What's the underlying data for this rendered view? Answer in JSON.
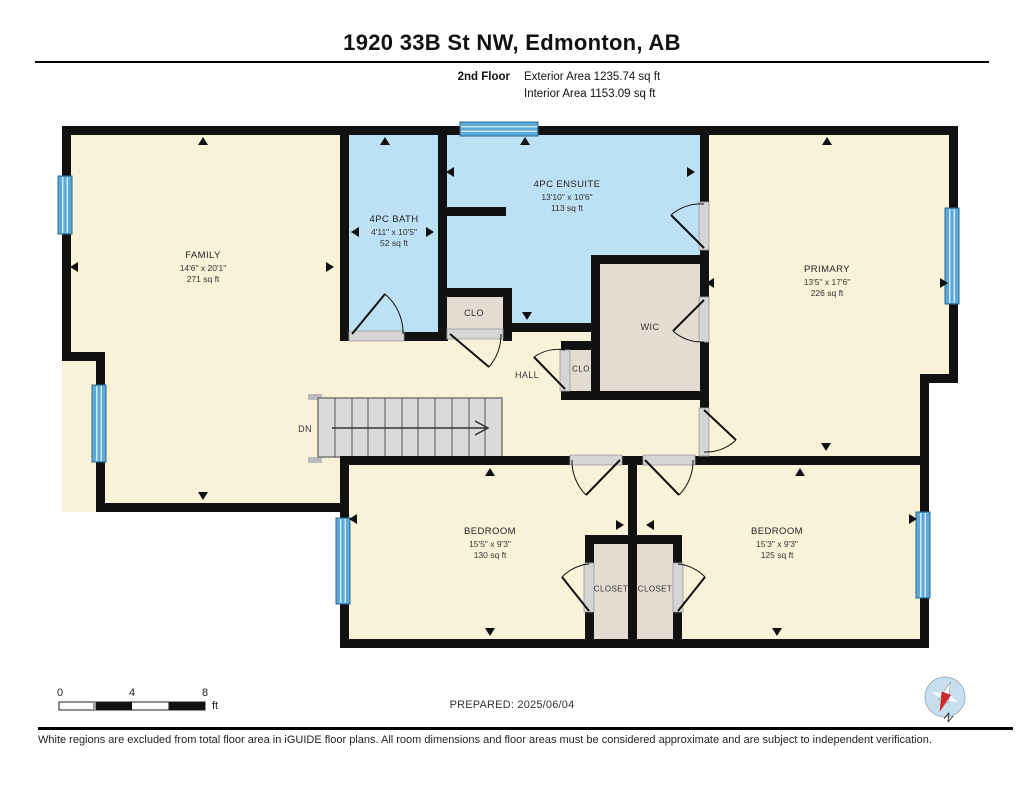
{
  "header": {
    "title": "1920 33B St NW, Edmonton, AB",
    "floor_label": "2nd Floor",
    "exterior_area": "Exterior Area 1235.74 sq ft",
    "interior_area": "Interior Area 1153.09 sq ft"
  },
  "rooms": {
    "family": {
      "name": "FAMILY",
      "dims": "14'6\" x 20'1\"",
      "area": "271 sq ft"
    },
    "bath": {
      "name": "4PC BATH",
      "dims": "4'11\" x 10'5\"",
      "area": "52 sq ft"
    },
    "ensuite": {
      "name": "4PC ENSUITE",
      "dims": "13'10\" x 10'6\"",
      "area": "113 sq ft"
    },
    "primary": {
      "name": "PRIMARY",
      "dims": "13'5\" x 17'6\"",
      "area": "226 sq ft"
    },
    "bedroom_left": {
      "name": "BEDROOM",
      "dims": "15'5\" x 9'3\"",
      "area": "130 sq ft"
    },
    "bedroom_right": {
      "name": "BEDROOM",
      "dims": "15'3\" x 9'3\"",
      "area": "125 sq ft"
    },
    "wic": {
      "name": "WIC"
    },
    "clo_upper": {
      "name": "CLO"
    },
    "clo_hall": {
      "name": "CLO"
    },
    "hall": {
      "name": "HALL"
    },
    "closet_left": {
      "name": "CLOSET"
    },
    "closet_right": {
      "name": "CLOSET"
    },
    "stairs": {
      "label": "DN"
    }
  },
  "footer": {
    "scale": {
      "tick0": "0",
      "tick4": "4",
      "tick8": "8",
      "unit": "ft"
    },
    "prepared": "PREPARED: 2025/06/04",
    "compass_north": "N",
    "disclaimer": "White regions are excluded from total floor area in iGUIDE floor plans. All room dimensions and floor areas must be considered approximate and are subject to independent verification."
  },
  "colors": {
    "wall": "#111111",
    "room_cream": "#FAF2D8",
    "room_blue": "#BCE0F4",
    "room_tan": "#E4DCD1",
    "window_blue": "#5EA9D8",
    "door_gray": "#D5D5D5",
    "stair_gray": "#DADADA",
    "compass_red": "#CC2A2A",
    "compass_blue": "#C6DEEE"
  }
}
